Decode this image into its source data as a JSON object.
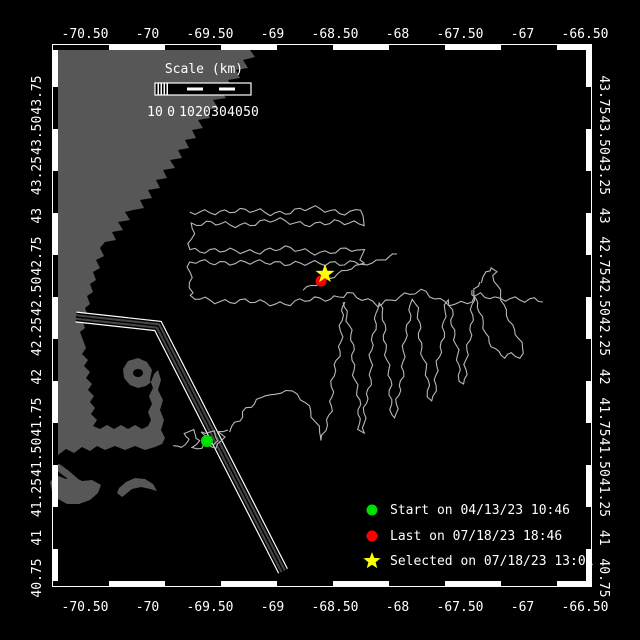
{
  "colors": {
    "background": "#000000",
    "land": "#575757",
    "track": "#b8b8b8",
    "lane_outline": "#ffffff",
    "lane_band": "#464646",
    "frame": "#ffffff",
    "text": "#ffffff",
    "start": "#00e000",
    "last": "#ff0000",
    "selected": "#ffff00"
  },
  "axes": {
    "lon_labels": [
      "-70.50",
      "-70",
      "-69.50",
      "-69",
      "-68.50",
      "-68",
      "-67.50",
      "-67",
      "-66.50"
    ],
    "lat_labels": [
      "43.75",
      "43.50",
      "43.25",
      "43",
      "42.75",
      "42.50",
      "42.25",
      "42",
      "41.75",
      "41.50",
      "41.25",
      "41",
      "40.75"
    ]
  },
  "scale_bar": {
    "title": "Scale (km)",
    "labels": [
      "10",
      "0",
      "10",
      "20",
      "30",
      "40",
      "50"
    ]
  },
  "legend": {
    "items": [
      {
        "marker": "start-dot",
        "color": "#00e000",
        "label": "Start on 04/13/23 10:46"
      },
      {
        "marker": "last-dot",
        "color": "#ff0000",
        "label": "Last on 07/18/23 18:46"
      },
      {
        "marker": "selected-star",
        "color": "#ffff00",
        "label": "Selected on 07/18/23 13:01"
      }
    ]
  },
  "map": {
    "frame": {
      "left": 53,
      "top": 45,
      "right": 591,
      "bottom": 586
    },
    "markers": {
      "start": {
        "x": 207,
        "y": 441,
        "r": 6
      },
      "last": {
        "x": 321,
        "y": 281,
        "r": 5.5
      },
      "selected": {
        "x": 325,
        "y": 274,
        "r": 10
      }
    },
    "land": [
      "53,45 258,45 250,50 255,57 243,60 248,68 236,70 240,78 228,80 233,88 220,90 226,98 213,100 218,108 206,110 210,118 198,120 203,128 192,130 196,138 185,140 189,148 178,150 182,158 170,160 175,168 163,170 167,178 156,180 160,188 148,190 152,198 140,200 144,208 133,210 125,212 130,220 118,222 123,230 112,232 116,240 105,242 100,248 104,256 96,260 100,268 93,272 96,280 90,284 93,292 87,296 90,304 85,308 88,316 82,320 85,328 80,332 83,340 86,348 82,354 88,360 84,366 90,372 86,378 92,384 88,390 94,396 90,402 95,408 91,414 97,420 93,426 100,429 107,425 114,429 121,425 128,429 135,425 142,429 148,426 151,420 148,412 152,404 149,396 153,388 150,380 152,370 147,362 138,358 128,361 123,369 124,378 130,385 138,388 146,386 151,382 154,374 158,370 161,380 158,390 163,400 160,410 164,420 161,430 165,438 162,444 155,447 145,450 135,446 125,450 115,446 105,450 97,446 90,451 82,447 74,453 66,449 58,455 53,452",
      "53,461 61,465 69,471 77,478 85,485 89,491 84,492 76,485 68,479 60,473 53,467",
      "56,475 66,479 74,477 82,481 92,480 101,485 98,493 90,500 79,504 67,504 58,499 52,491 50,482",
      "119,488 126,482 135,478 145,479 153,484 157,491 150,489 141,487 132,489 126,494 122,497 117,493",
      "148,118 154,116 157,122 151,125",
      "168,128 174,126 177,132 171,135",
      "186,98 192,96 195,102 189,105",
      "206,88 212,86 215,92 209,95",
      "226,60 232,58 235,64 229,67",
      "160,150 166,148 169,154 163,157",
      "120,206 125,204 127,209 122,211"
    ],
    "harbor_hole": {
      "cx": 138,
      "cy": 373,
      "rx": 5,
      "ry": 4
    },
    "lane": [
      [
        76,
        317
      ],
      [
        158,
        326
      ],
      [
        283,
        571
      ]
    ],
    "track": [
      {
        "amp": 1.2,
        "pts": [
          [
            174,
            444
          ],
          [
            182,
            448
          ],
          [
            190,
            438
          ],
          [
            184,
            433
          ],
          [
            193,
            430
          ],
          [
            200,
            441
          ],
          [
            192,
            447
          ],
          [
            203,
            449
          ],
          [
            210,
            437
          ],
          [
            201,
            432
          ],
          [
            214,
            431
          ],
          [
            218,
            442
          ],
          [
            208,
            446
          ],
          [
            216,
            448
          ],
          [
            224,
            438
          ],
          [
            218,
            432
          ],
          [
            228,
            430
          ]
        ]
      },
      {
        "amp": 2.0,
        "pts": [
          [
            228,
            430
          ],
          [
            240,
            421
          ],
          [
            247,
            409
          ],
          [
            257,
            400
          ],
          [
            266,
            393
          ],
          [
            276,
            396
          ],
          [
            286,
            390
          ],
          [
            296,
            396
          ],
          [
            306,
            402
          ],
          [
            314,
            416
          ],
          [
            320,
            432
          ],
          [
            323,
            441
          ],
          [
            328,
            420
          ],
          [
            332,
            392
          ],
          [
            336,
            365
          ],
          [
            340,
            342
          ],
          [
            343,
            315
          ],
          [
            345,
            302
          ]
        ]
      },
      {
        "amp": 1.8,
        "pts": [
          [
            345,
            302
          ],
          [
            350,
            330
          ],
          [
            354,
            365
          ],
          [
            358,
            400
          ],
          [
            360,
            428
          ],
          [
            363,
            433
          ],
          [
            366,
            408
          ],
          [
            370,
            375
          ],
          [
            373,
            340
          ],
          [
            376,
            308
          ],
          [
            379,
            303
          ],
          [
            383,
            320
          ],
          [
            387,
            355
          ],
          [
            390,
            390
          ],
          [
            393,
            414
          ],
          [
            396,
            418
          ],
          [
            399,
            395
          ],
          [
            403,
            362
          ],
          [
            407,
            330
          ],
          [
            410,
            305
          ],
          [
            414,
            299
          ],
          [
            418,
            318
          ],
          [
            422,
            348
          ],
          [
            426,
            375
          ],
          [
            429,
            396
          ],
          [
            432,
            401
          ],
          [
            436,
            380
          ],
          [
            440,
            352
          ],
          [
            444,
            322
          ],
          [
            448,
            300
          ],
          [
            452,
            310
          ],
          [
            455,
            340
          ],
          [
            458,
            365
          ],
          [
            461,
            380
          ],
          [
            464,
            384
          ],
          [
            467,
            360
          ],
          [
            470,
            330
          ],
          [
            473,
            305
          ],
          [
            476,
            290
          ],
          [
            480,
            282
          ]
        ]
      },
      {
        "amp": 1.4,
        "pts": [
          [
            480,
            282
          ],
          [
            486,
            272
          ],
          [
            492,
            267
          ],
          [
            496,
            271
          ],
          [
            492,
            276
          ],
          [
            497,
            286
          ],
          [
            502,
            300
          ],
          [
            508,
            315
          ],
          [
            514,
            330
          ],
          [
            520,
            343
          ],
          [
            524,
            354
          ],
          [
            520,
            358
          ],
          [
            512,
            354
          ],
          [
            505,
            358
          ],
          [
            498,
            352
          ],
          [
            490,
            342
          ],
          [
            484,
            328
          ],
          [
            479,
            312
          ],
          [
            475,
            298
          ],
          [
            472,
            290
          ]
        ]
      },
      {
        "amp": 2.4,
        "pts": [
          [
            190,
            214
          ],
          [
            230,
            210
          ],
          [
            270,
            213
          ],
          [
            310,
            209
          ],
          [
            350,
            212
          ],
          [
            362,
            210
          ],
          [
            364,
            222
          ],
          [
            320,
            224
          ],
          [
            275,
            221
          ],
          [
            230,
            225
          ],
          [
            192,
            223
          ],
          [
            190,
            249
          ],
          [
            235,
            252
          ],
          [
            280,
            249
          ],
          [
            325,
            252
          ],
          [
            362,
            250
          ],
          [
            364,
            264
          ],
          [
            330,
            262
          ],
          [
            300,
            265
          ],
          [
            270,
            261
          ],
          [
            240,
            264
          ],
          [
            210,
            261
          ],
          [
            191,
            262
          ],
          [
            190,
            298
          ],
          [
            240,
            302
          ],
          [
            290,
            303
          ],
          [
            330,
            298
          ],
          [
            347,
            293
          ],
          [
            362,
            300
          ],
          [
            377,
            305
          ],
          [
            395,
            297
          ],
          [
            420,
            292
          ],
          [
            440,
            300
          ],
          [
            455,
            303
          ],
          [
            467,
            303
          ],
          [
            480,
            296
          ],
          [
            495,
            299
          ],
          [
            510,
            297
          ],
          [
            525,
            300
          ],
          [
            543,
            302
          ]
        ]
      },
      {
        "amp": 1.4,
        "pts": [
          [
            303,
            290
          ],
          [
            320,
            282
          ],
          [
            338,
            274
          ],
          [
            356,
            267
          ],
          [
            372,
            262
          ],
          [
            385,
            258
          ],
          [
            397,
            254
          ]
        ]
      }
    ]
  }
}
